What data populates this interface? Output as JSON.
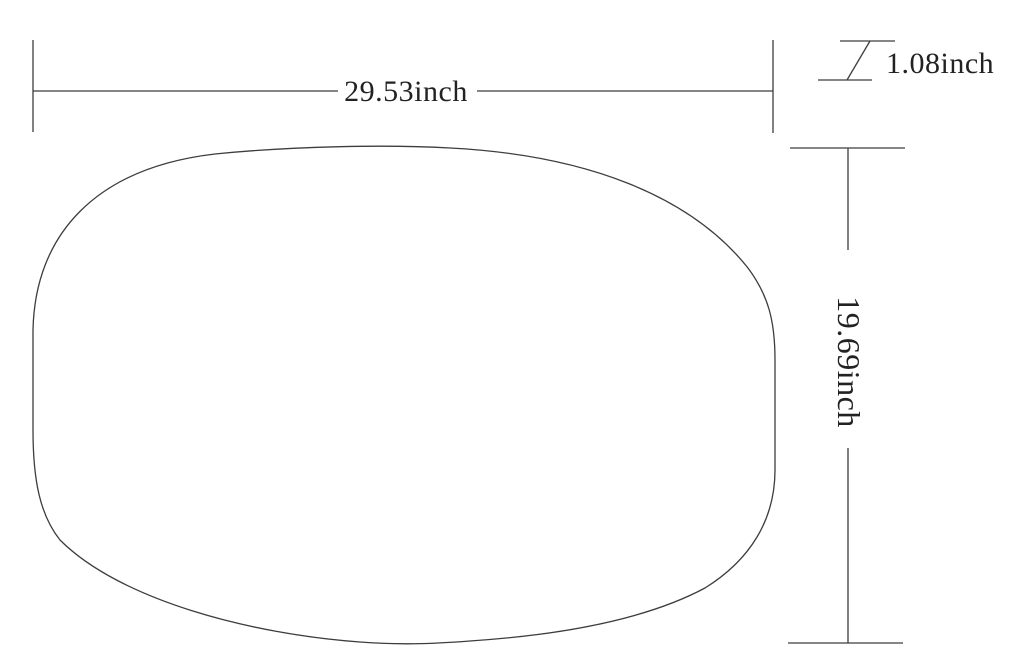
{
  "drawing": {
    "shape": "rounded-oval-panel-outline",
    "unit": "inch",
    "labels": {
      "width": "29.53inch",
      "thickness": "1.08inch",
      "height": "19.69inch"
    },
    "values_inch": {
      "width": 29.53,
      "thickness": 1.08,
      "height": 19.69
    },
    "line_color": "#3d3d3d",
    "text_color": "#222222",
    "background_color": "#ffffff"
  }
}
